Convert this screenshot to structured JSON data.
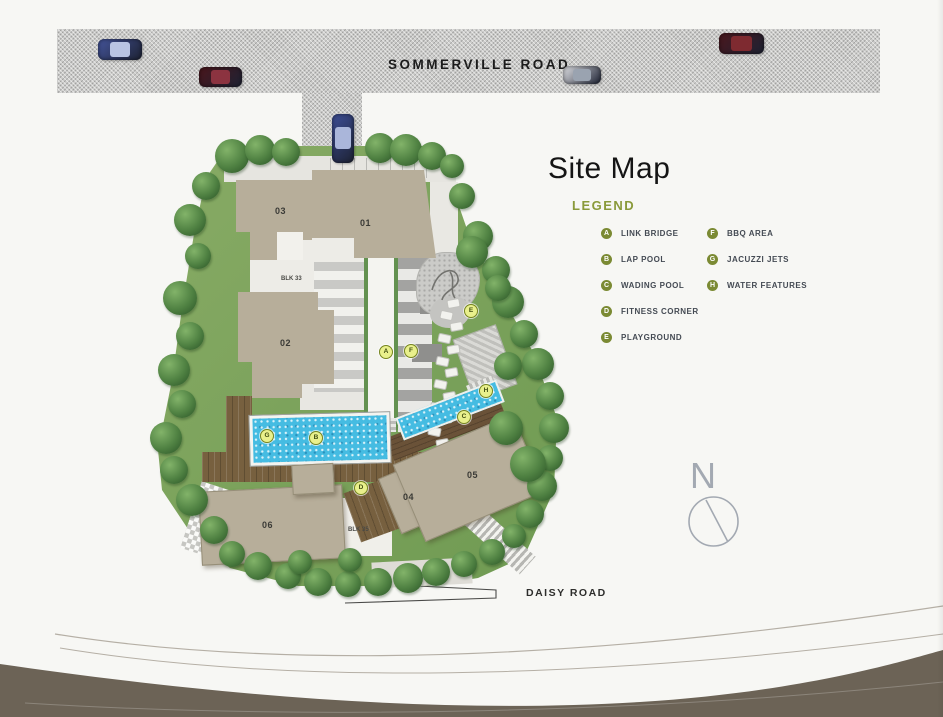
{
  "title": "Site Map",
  "legend": {
    "heading": "LEGEND",
    "items": [
      {
        "key": "A",
        "label": "LINK BRIDGE"
      },
      {
        "key": "B",
        "label": "LAP POOL"
      },
      {
        "key": "C",
        "label": "WADING POOL"
      },
      {
        "key": "D",
        "label": "FITNESS CORNER"
      },
      {
        "key": "E",
        "label": "PLAYGROUND"
      },
      {
        "key": "F",
        "label": "BBQ AREA"
      },
      {
        "key": "G",
        "label": "JACUZZI JETS"
      },
      {
        "key": "H",
        "label": "WATER FEATURES"
      }
    ]
  },
  "roads": {
    "top_label": "SOMMERVILLE ROAD",
    "bottom_label": "DAISY ROAD"
  },
  "compass": {
    "label": "N"
  },
  "site": {
    "buildings": [
      {
        "label": "01",
        "x": 360,
        "y": 218
      },
      {
        "label": "02",
        "x": 280,
        "y": 338
      },
      {
        "label": "03",
        "x": 275,
        "y": 206
      },
      {
        "label": "04",
        "x": 403,
        "y": 492
      },
      {
        "label": "05",
        "x": 467,
        "y": 470
      },
      {
        "label": "06",
        "x": 262,
        "y": 520
      },
      {
        "label": "BLK 33",
        "x": 281,
        "y": 276
      },
      {
        "label": "BLK 35",
        "x": 348,
        "y": 527
      }
    ],
    "markers": [
      {
        "key": "A",
        "x": 386,
        "y": 352
      },
      {
        "key": "B",
        "x": 316,
        "y": 438
      },
      {
        "key": "C",
        "x": 464,
        "y": 417
      },
      {
        "key": "D",
        "x": 361,
        "y": 488
      },
      {
        "key": "E",
        "x": 471,
        "y": 311
      },
      {
        "key": "F",
        "x": 411,
        "y": 351
      },
      {
        "key": "G",
        "x": 267,
        "y": 436
      },
      {
        "key": "H",
        "x": 486,
        "y": 391
      }
    ]
  },
  "colors": {
    "legend_badge": "#7b8a33",
    "legend_heading": "#8a9a3a",
    "map_marker_fill": "#e9f08c",
    "map_marker_border": "#75841e",
    "road_gray": "#cbcbc9",
    "building_tan": "#b7ae9a",
    "pool_blue": "#45bce2",
    "deck_brown": "#77603f",
    "grass_green": "#7aa55b",
    "tree_green": "#4f8142",
    "footer_taupe": "#6c6356"
  }
}
